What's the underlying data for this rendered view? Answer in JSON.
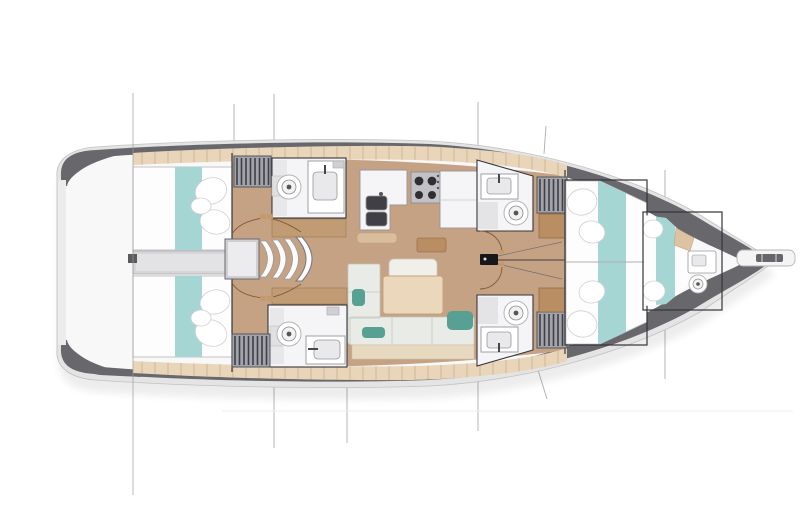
{
  "meta": {
    "title": "sailing-yacht-interior-floor-plan",
    "view": "deck plan, bow pointing right",
    "width": 800,
    "height": 505
  },
  "rooms": [
    "aft-cabin-port",
    "aft-cabin-starboard",
    "aft-head-port",
    "aft-head-starboard",
    "companionway-stairs",
    "galley",
    "salon",
    "forward-head-port",
    "forward-head-starboard",
    "owners-cabin",
    "forepeak-cabin",
    "transom-platform"
  ],
  "fixtures": [
    "double-berth",
    "toilet",
    "washbasin",
    "double-sink",
    "stove",
    "fridge-counter",
    "wardrobe",
    "sofa",
    "saloon-table",
    "mast",
    "bowsprit",
    "rigging-lines",
    "door-swing-arcs"
  ],
  "palette": {
    "bg": "#ffffff",
    "hullRim": "#e4e4e4",
    "hullRimLine": "#c2c2c2",
    "hullDark": "#67676c",
    "deck": "#f8f8f8",
    "floor": "#c5a284",
    "plank": "#e9d6ba",
    "plankLine": "#cbae8e",
    "wood": "#b98e63",
    "woodLight": "#dcc3a2",
    "cabinetTan": "#c09b73",
    "bed": "#fdfdfd",
    "bedLine": "#bcbcbc",
    "teal": "#a5d6d3",
    "tealDark": "#57a093",
    "sofa": "#e9ece6",
    "sofaLine": "#c3c8c0",
    "sofaFront": "#e6d9c0",
    "table": "#ead7bc",
    "tableLine": "#c4a47e",
    "fixture": "#f5f5f7",
    "fixtureLine": "#97979d",
    "fixtureFill": "#e9e9eb",
    "wall": "#35353a",
    "wardrobe": "#a3a3ab",
    "wardrobeStripe": "#3f3f46",
    "stair": "#cfcfd3",
    "stairLight": "#ececee",
    "mast": "#17171b",
    "door": "#8a5a33",
    "rig": "#9a9a9a",
    "rigDark": "#6f6f74",
    "water": "#ededed"
  },
  "wardrobes": [
    {
      "x": 234,
      "y": 156,
      "w": 37,
      "h": 31
    },
    {
      "x": 232,
      "y": 334,
      "w": 38,
      "h": 33
    },
    {
      "x": 537,
      "y": 177,
      "w": 30,
      "h": 36
    },
    {
      "x": 537,
      "y": 312,
      "w": 30,
      "h": 36
    }
  ],
  "rigging": {
    "over_line": {
      "x": 133,
      "y1": 93,
      "y2": 495
    },
    "under_lines": [
      {
        "x1": 234,
        "y1": 104,
        "x2": 234,
        "y2": 386
      },
      {
        "x1": 274,
        "y1": 94,
        "x2": 274,
        "y2": 448
      },
      {
        "x1": 347,
        "y1": 358,
        "x2": 347,
        "y2": 443
      },
      {
        "x1": 478,
        "y1": 102,
        "x2": 478,
        "y2": 431
      },
      {
        "x1": 546,
        "y1": 126,
        "x2": 544,
        "y2": 154
      },
      {
        "x1": 538,
        "y1": 370,
        "x2": 547,
        "y2": 399
      },
      {
        "x1": 665,
        "y1": 170,
        "x2": 665,
        "y2": 379
      }
    ],
    "waterline": {
      "x1": 222,
      "y1": 411,
      "x2": 793,
      "y2": 411
    }
  }
}
